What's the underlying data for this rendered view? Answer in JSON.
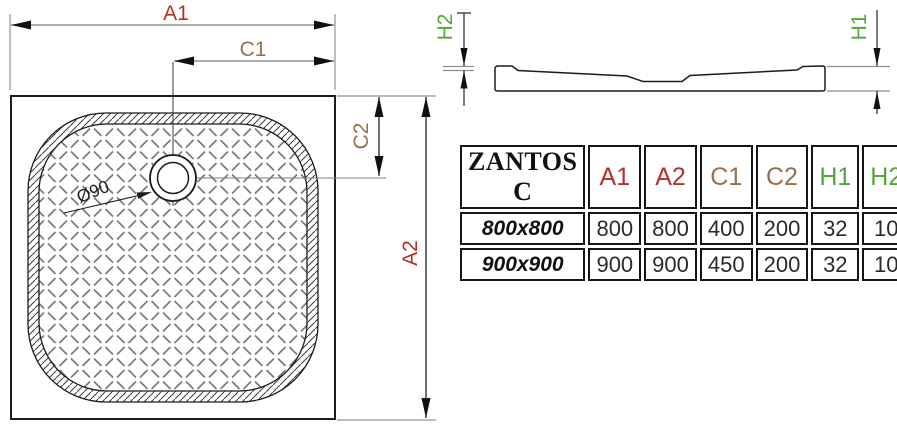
{
  "plan_view": {
    "dim_a1": "A1",
    "dim_c1": "C1",
    "dim_c2": "C2",
    "dim_a2": "A2",
    "drain_label": "Ø90"
  },
  "profile_view": {
    "dim_h2": "H2",
    "dim_h1": "H1"
  },
  "table": {
    "title": "ZANTOS C",
    "headers": [
      "A1",
      "A2",
      "C1",
      "C2",
      "H1",
      "H2"
    ],
    "rows": [
      {
        "size": "800x800",
        "a1": "800",
        "a2": "800",
        "c1": "400",
        "c2": "200",
        "h1": "32",
        "h2": "10"
      },
      {
        "size": "900x900",
        "a1": "900",
        "a2": "900",
        "c1": "450",
        "c2": "200",
        "h1": "32",
        "h2": "10"
      }
    ]
  },
  "colors": {
    "a_labels": "#b5302a",
    "c_labels": "#96714d",
    "h_labels": "#57a33c",
    "outline": "#1c1c1c",
    "extension_lines": "#8f8f8f",
    "texture": "#7a7a7a"
  }
}
